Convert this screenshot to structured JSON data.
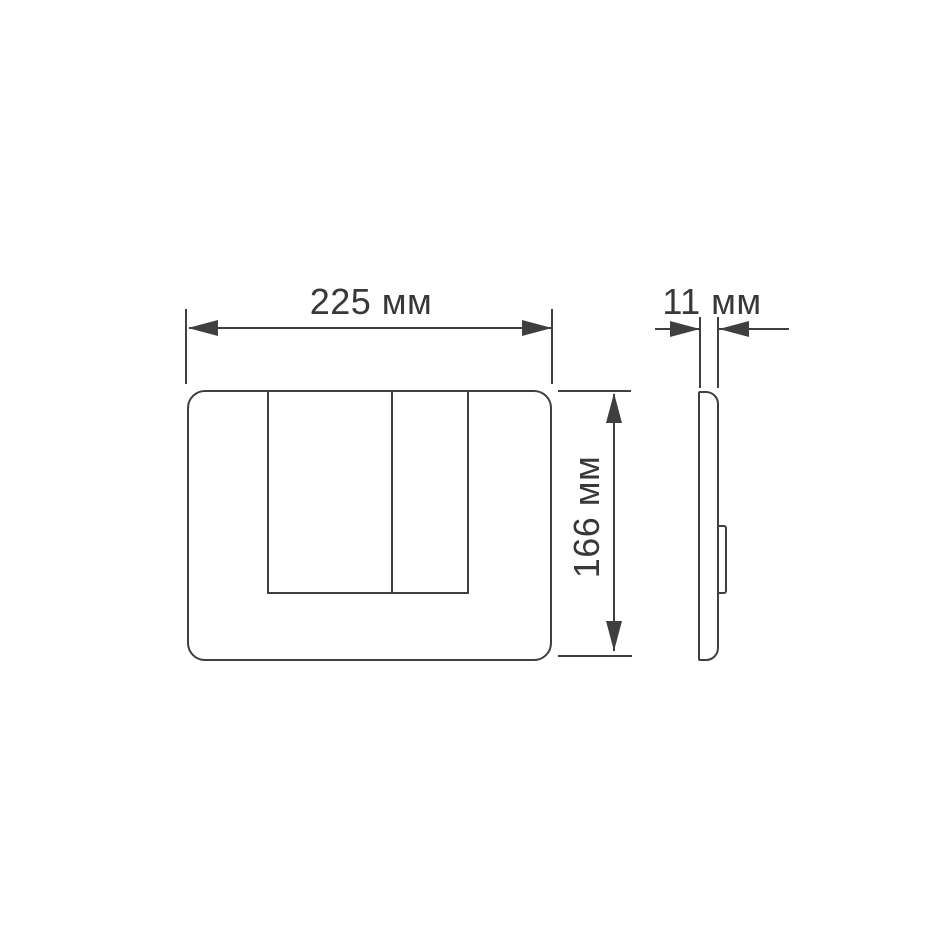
{
  "drawing": {
    "kind": "technical-dimension-drawing",
    "subject": "dual-flush toilet actuator plate, front and side views",
    "background_color": "#ffffff",
    "line_color": "#3f3f3f",
    "text_color": "#383838",
    "views": [
      {
        "name": "front-view",
        "features": [
          "rounded plate outline",
          "large flush button",
          "small flush button"
        ]
      },
      {
        "name": "side-view",
        "features": [
          "thin plate profile",
          "rear mounting clip"
        ]
      }
    ],
    "dimensions": {
      "width": {
        "value": 225,
        "unit": "мм",
        "label": "225 мм",
        "applies_to": "front view overall width"
      },
      "height": {
        "value": 166,
        "unit": "мм",
        "label": "166 мм",
        "applies_to": "front view overall height"
      },
      "thickness": {
        "value": 11,
        "unit": "мм",
        "label": "11 мм",
        "applies_to": "side view overall depth"
      }
    }
  }
}
